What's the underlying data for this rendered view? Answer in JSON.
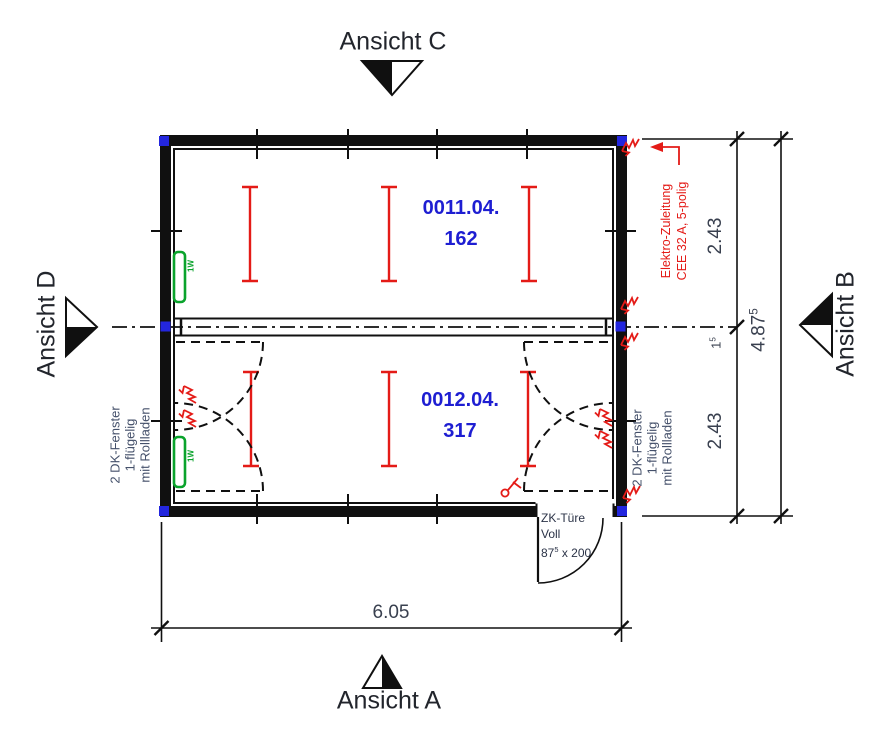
{
  "views": {
    "top": "Ansicht C",
    "bottom": "Ansicht A",
    "left": "Ansicht D",
    "right": "Ansicht B"
  },
  "rooms": [
    {
      "code": "0011.04.",
      "number": "162"
    },
    {
      "code": "0012.04.",
      "number": "317"
    }
  ],
  "dimensions": {
    "bottom_total": "6.05",
    "right_seg_top": "2.43",
    "right_seg_mid": {
      "main": "1",
      "sup": "5"
    },
    "right_seg_bottom": "2.43",
    "right_total": {
      "main": "4.87",
      "sup": "5"
    }
  },
  "annotations": {
    "electric": {
      "line1": "Elektro-Zuleitung",
      "line2": "CEE 32 A, 5-polig"
    },
    "window_left": {
      "line1": "2 DK-Fenster",
      "line2": "1-flügelig",
      "line3": "mit Rollladen"
    },
    "window_right": {
      "line1": "2 DK-Fenster",
      "line2": "1-flügelig",
      "line3": "mit Rollladen"
    },
    "door": {
      "line1": "ZK-Türe",
      "line2": "Voll",
      "size_main": "87",
      "size_sup": "5",
      "size_rest": " x 200"
    },
    "window_tag": "1W"
  },
  "colors": {
    "room_label": "#1e1ed2",
    "red": "#e41b17",
    "green": "#0aa32c",
    "node_blue": "#2326de",
    "line": "#101010"
  }
}
